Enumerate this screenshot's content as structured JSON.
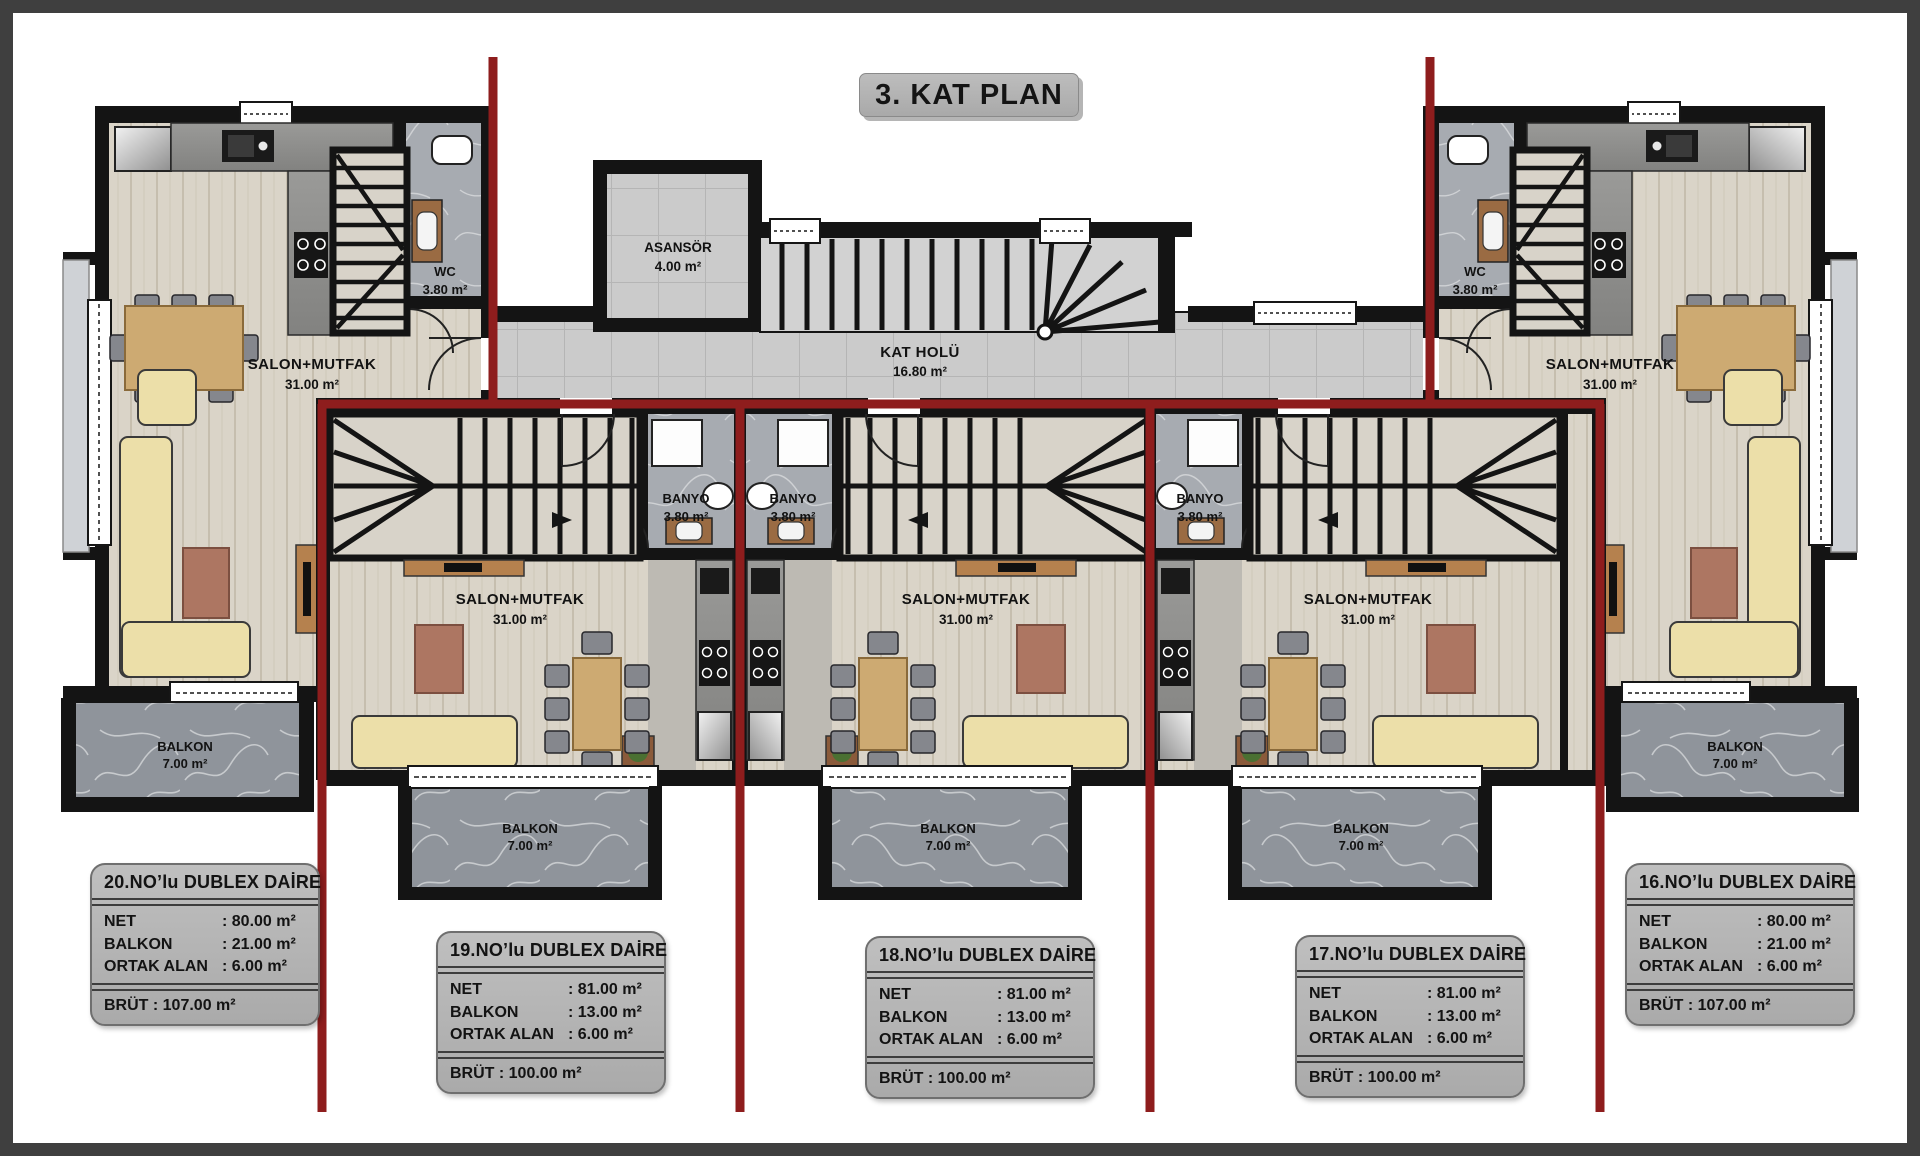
{
  "title": "3. KAT PLAN",
  "rooms": {
    "asansor": {
      "name": "ASANSÖR",
      "area": "4.00 m²"
    },
    "kat_holu": {
      "name": "KAT HOLÜ",
      "area": "16.80 m²"
    },
    "wc_left": {
      "name": "WC",
      "area": "3.80 m²"
    },
    "wc_right": {
      "name": "WC",
      "area": "3.80 m²"
    },
    "salon_20": {
      "name": "SALON+MUTFAK",
      "area": "31.00 m²"
    },
    "salon_19": {
      "name": "SALON+MUTFAK",
      "area": "31.00 m²"
    },
    "salon_18": {
      "name": "SALON+MUTFAK",
      "area": "31.00 m²"
    },
    "salon_17": {
      "name": "SALON+MUTFAK",
      "area": "31.00 m²"
    },
    "salon_16": {
      "name": "SALON+MUTFAK",
      "area": "31.00 m²"
    },
    "banyo_19": {
      "name": "BANYO",
      "area": "3.80 m²"
    },
    "banyo_18": {
      "name": "BANYO",
      "area": "3.80 m²"
    },
    "banyo_17": {
      "name": "BANYO",
      "area": "3.80 m²"
    },
    "balkon_20": {
      "name": "BALKON",
      "area": "7.00 m²"
    },
    "balkon_19": {
      "name": "BALKON",
      "area": "7.00 m²"
    },
    "balkon_18": {
      "name": "BALKON",
      "area": "7.00 m²"
    },
    "balkon_17": {
      "name": "BALKON",
      "area": "7.00 m²"
    },
    "balkon_16": {
      "name": "BALKON",
      "area": "7.00 m²"
    }
  },
  "cards": [
    {
      "title": "20.NO’lu DUBLEX DAİRE",
      "rows": [
        {
          "label": "NET",
          "value": ": 80.00 m²"
        },
        {
          "label": "BALKON",
          "value": ": 21.00 m²"
        },
        {
          "label": "ORTAK ALAN",
          "value": ": 6.00 m²"
        }
      ],
      "brut": "BRÜT : 107.00 m²"
    },
    {
      "title": "19.NO’lu DUBLEX DAİRE",
      "rows": [
        {
          "label": "NET",
          "value": ": 81.00 m²"
        },
        {
          "label": "BALKON",
          "value": ": 13.00 m²"
        },
        {
          "label": "ORTAK ALAN",
          "value": ": 6.00 m²"
        }
      ],
      "brut": "BRÜT : 100.00 m²"
    },
    {
      "title": "18.NO’lu DUBLEX DAİRE",
      "rows": [
        {
          "label": "NET",
          "value": ": 81.00 m²"
        },
        {
          "label": "BALKON",
          "value": ": 13.00 m²"
        },
        {
          "label": "ORTAK ALAN",
          "value": ": 6.00 m²"
        }
      ],
      "brut": "BRÜT : 100.00 m²"
    },
    {
      "title": "17.NO’lu DUBLEX DAİRE",
      "rows": [
        {
          "label": "NET",
          "value": ": 81.00 m²"
        },
        {
          "label": "BALKON",
          "value": ": 13.00 m²"
        },
        {
          "label": "ORTAK ALAN",
          "value": ": 6.00 m²"
        }
      ],
      "brut": "BRÜT : 100.00 m²"
    },
    {
      "title": "16.NO’lu DUBLEX DAİRE",
      "rows": [
        {
          "label": "NET",
          "value": ": 80.00 m²"
        },
        {
          "label": "BALKON",
          "value": ": 21.00 m²"
        },
        {
          "label": "ORTAK ALAN",
          "value": ": 6.00 m²"
        }
      ],
      "brut": "BRÜT : 107.00 m²"
    }
  ],
  "colors": {
    "divider_red": "#8e1d1d",
    "wall_black": "#141414"
  }
}
